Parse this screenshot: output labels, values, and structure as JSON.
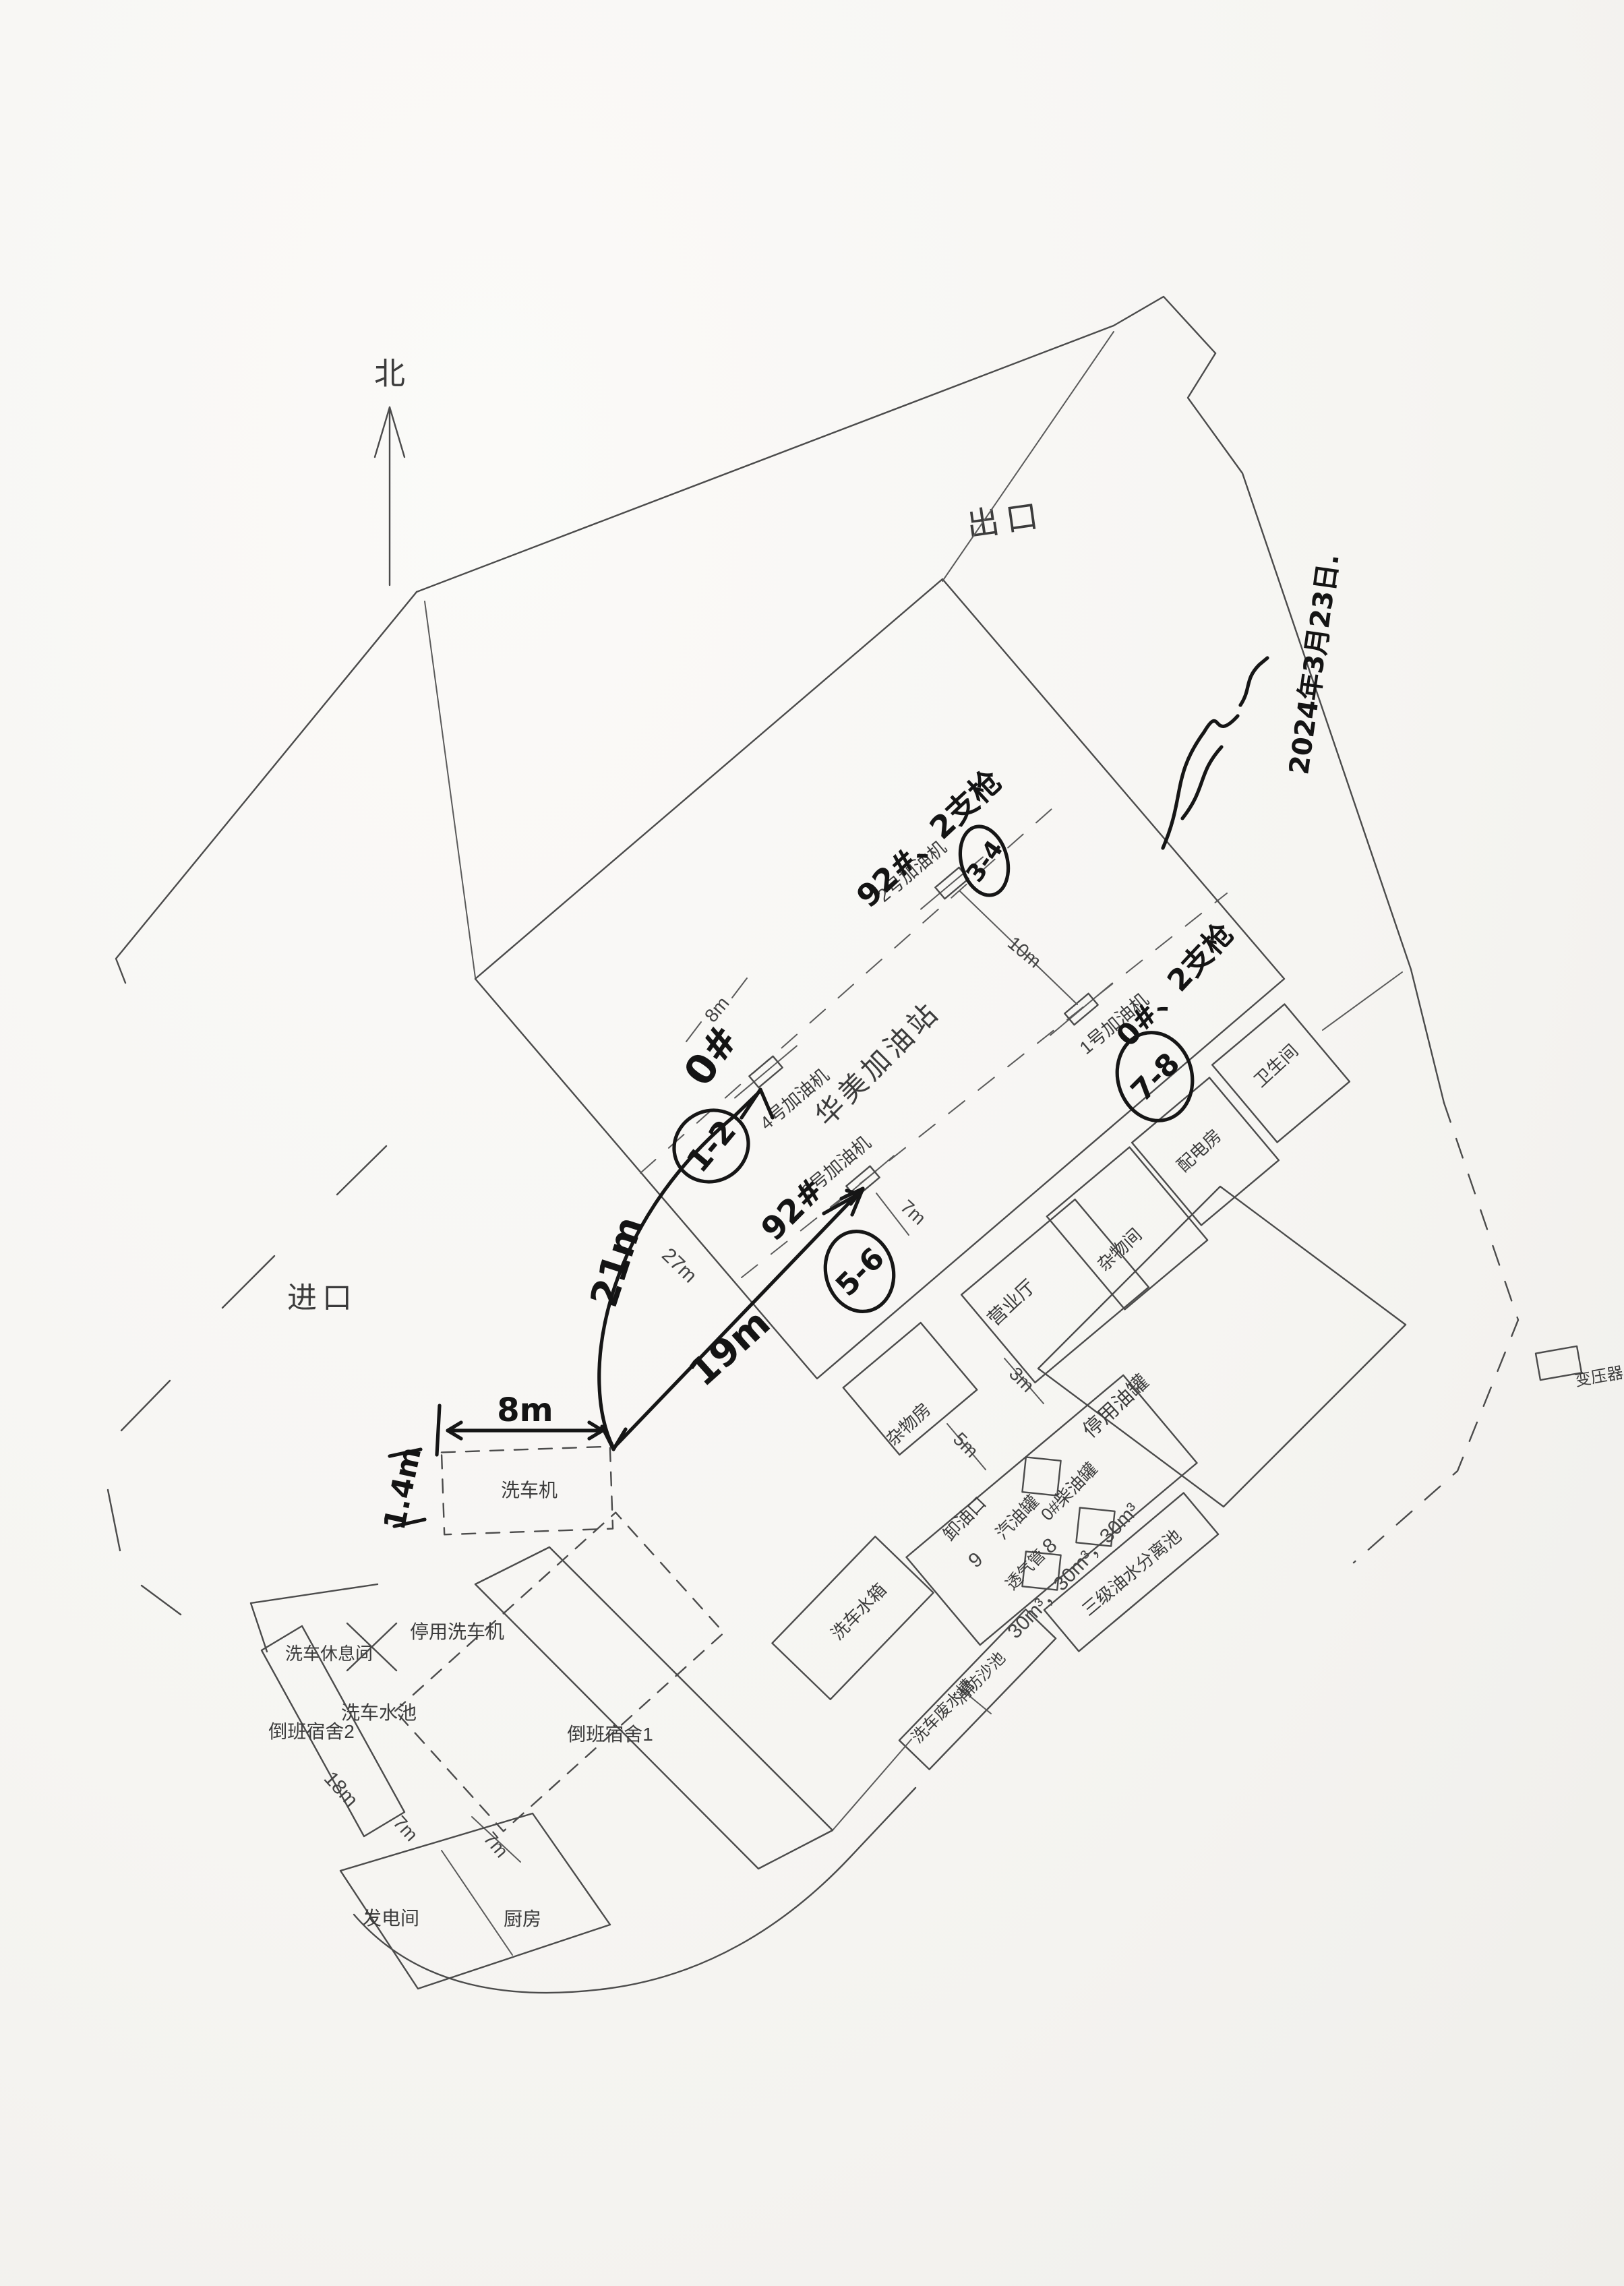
{
  "compass": {
    "north_label": "北"
  },
  "access": {
    "exit_label": "出口",
    "entrance_label": "进口"
  },
  "station": {
    "name_label": "华美加油站"
  },
  "dispensers": {
    "d1": "1号加油机",
    "d2": "2号加油机",
    "d3": "3号加油机",
    "d4": "4号加油机"
  },
  "buildings": {
    "business_hall": "营业厅",
    "sundries_room_ne": "杂物间",
    "power_room": "配电房",
    "toilet": "卫生间",
    "sundries_room_sw": "杂物房",
    "disused_tanks": "停用油罐",
    "unloading_port": "卸油口",
    "gasoline_tank": "汽油罐",
    "diesel_tank": "0#柴油罐",
    "vent_pipe": "透气管",
    "oil_water_separator": "三级油水分离池",
    "wash_water_tank": "洗车水箱",
    "wash_waste_trough": "洗车废水槽",
    "fire_sand_pool": "消防沙池",
    "car_washer": "洗车机",
    "disused_car_washer": "停用洗车机",
    "wash_rest_room": "洗车休息间",
    "wash_pool": "洗车水池",
    "dorm2": "倒班宿舍2",
    "dorm1": "倒班宿舍1",
    "generator_room": "发电间",
    "kitchen": "厨房",
    "transformer": "变压器"
  },
  "dimensions": {
    "canopy_bay": "8m",
    "d2_to_d1": "10m",
    "d3_to_edge": "7m",
    "canopy_sw_edge": "27m",
    "hall_to_tanks": "3m",
    "tanks_to_room": "5m",
    "dorm2_length": "18m",
    "dorm2_gap": "7m",
    "dorm1_gap": "7m",
    "tank_volumes": "30m³，30m³，30m³"
  },
  "point_numbers": {
    "vent_pipe_no": "8",
    "unloading_no": "9"
  },
  "handwritten": {
    "date": "2024年3月23日.",
    "d4_fuel": "0#",
    "d4_nozzles": "1-2",
    "d2_fuel": "92#、2支枪",
    "d2_nozzles": "3-4",
    "d3_fuel": "92#",
    "d3_nozzles": "5-6",
    "d1_fuel": "0#、2支枪",
    "d1_nozzles": "7-8",
    "dim_washer_width": "8m",
    "dim_washer_side": "1.4m",
    "dim_washer_to_d4": "21m",
    "dim_washer_to_d3": "19m"
  }
}
